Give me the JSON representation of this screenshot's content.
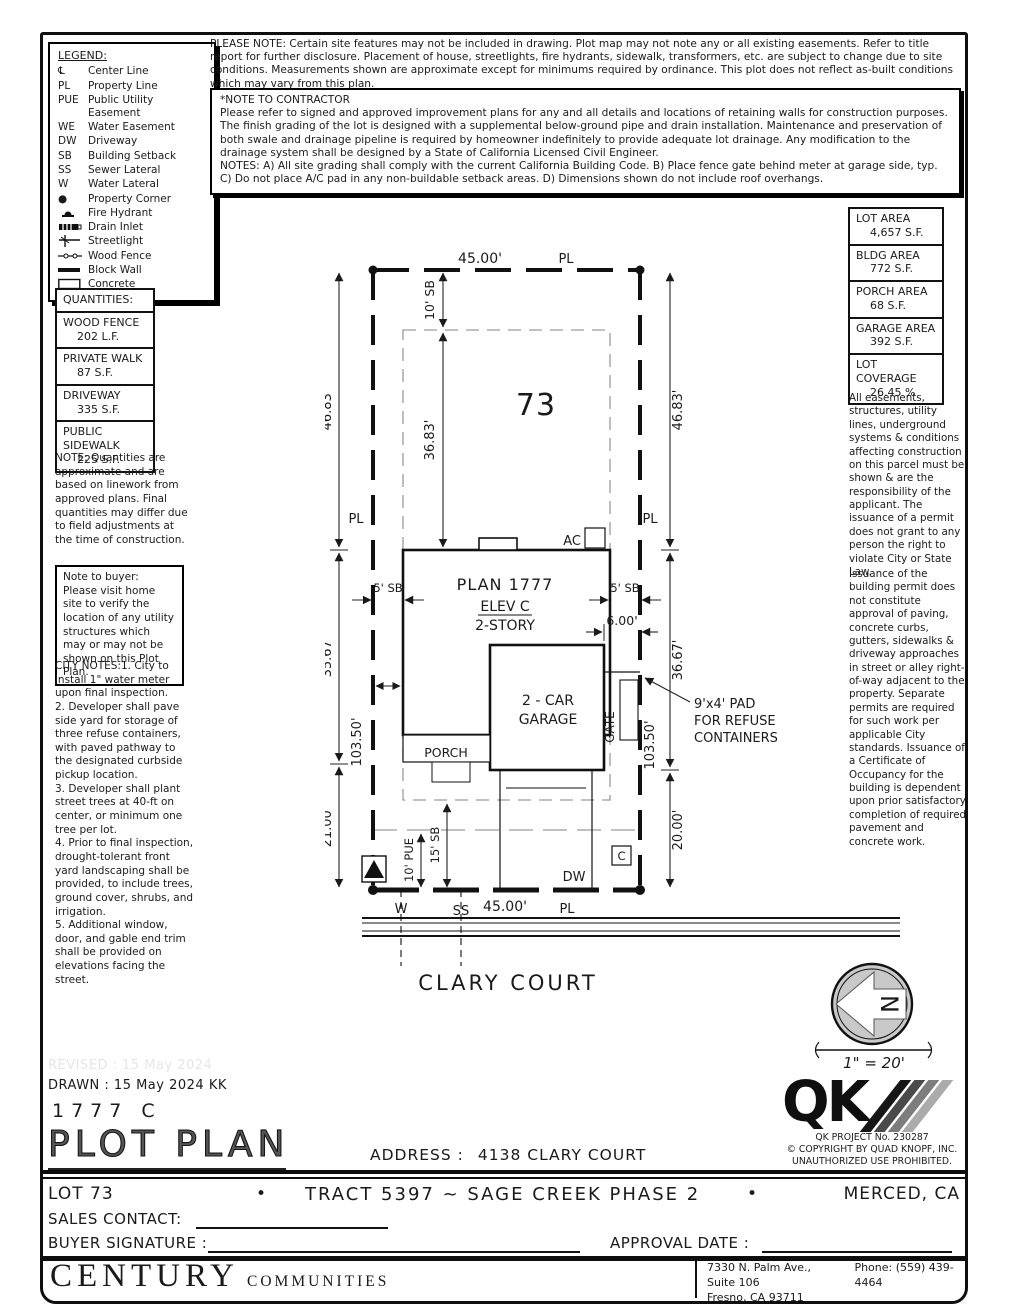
{
  "header": {
    "please_note": "PLEASE NOTE:  Certain site features may not be included in drawing.  Plot map may not note any or all existing easements. Refer to title report for further disclosure.  Placement of house, streetlights, fire hydrants, sidewalk, transformers, etc. are subject to change due to site conditions.  Measurements shown are approximate except for minimums required by ordinance.  This plot does not reflect as-built conditions which may vary from this plan.",
    "contractor_note": {
      "title": "*NOTE TO CONTRACTOR",
      "line1": "Please refer to signed and approved improvement plans for any and all details and locations of retaining walls for construction purposes.",
      "line2": "The finish grading of the lot is designed with a supplemental below-ground pipe and drain installation.  Maintenance and preservation of both swale and drainage pipeline is required by homeowner indefinitely to provide adequate lot drainage.  Any modification to the drainage system shall be designed by a State of California Licensed Civil Engineer.",
      "line3": "NOTES:  A) All site grading shall comply with the current California Building Code.  B) Place fence gate behind meter at garage side, typ.  C) Do not place A/C pad in any non-buildable setback areas.  D) Dimensions shown do not include roof overhangs."
    }
  },
  "legend": {
    "title": "LEGEND:",
    "items": [
      {
        "abbr": "℄",
        "label": "Center Line"
      },
      {
        "abbr": "PL",
        "label": "Property Line"
      },
      {
        "abbr": "PUE",
        "label": "Public Utility Easement"
      },
      {
        "abbr": "WE",
        "label": "Water Easement"
      },
      {
        "abbr": "DW",
        "label": "Driveway"
      },
      {
        "abbr": "SB",
        "label": "Building Setback"
      },
      {
        "abbr": "SS",
        "label": "Sewer Lateral"
      },
      {
        "abbr": "W",
        "label": "Water Lateral"
      },
      {
        "abbr": "●",
        "label": "Property Corner"
      },
      {
        "abbr": "",
        "label": "Fire Hydrant"
      },
      {
        "abbr": "",
        "label": "Drain Inlet"
      },
      {
        "abbr": "",
        "label": "Streetlight"
      },
      {
        "abbr": "",
        "label": "Wood Fence"
      },
      {
        "abbr": "",
        "label": "Block Wall"
      },
      {
        "abbr": "",
        "label": "Concrete"
      }
    ]
  },
  "areas": {
    "rows": [
      {
        "label": "LOT AREA",
        "value": "4,657 S.F."
      },
      {
        "label": "BLDG AREA",
        "value": "772 S.F."
      },
      {
        "label": "PORCH AREA",
        "value": "68 S.F."
      },
      {
        "label": "GARAGE AREA",
        "value": "392 S.F."
      },
      {
        "label": "LOT COVERAGE",
        "value": "26.45 %"
      }
    ]
  },
  "quantities": {
    "title": "QUANTITIES:",
    "rows": [
      {
        "label": "WOOD FENCE",
        "value": "202 L.F."
      },
      {
        "label": "PRIVATE WALK",
        "value": "87 S.F."
      },
      {
        "label": "DRIVEWAY",
        "value": "335 S.F."
      },
      {
        "label": "PUBLIC SIDEWALK",
        "value": "225 S.F."
      }
    ],
    "note": "NOTE: Quantities are approximate and are based on linework from approved plans.  Final quantities may differ due to field adjustments at the time of construction."
  },
  "buyer_note": "Note to buyer: Please visit home site to verify the location of any utility structures which may or may not be shown on this Plot Plan.",
  "city_notes": {
    "title": "CITY NOTES:",
    "body": "1. City to install 1\" water meter upon final inspection.\n2. Developer shall pave side yard for storage of three refuse containers, with paved pathway to the designated curbside pickup location.\n3. Developer shall plant street trees at 40-ft on center, or minimum one tree per lot.\n4. Prior to final inspection, drought-tolerant front yard landscaping shall be provided, to include trees, ground cover, shrubs, and irrigation.\n5. Additional window, door, and gable end trim shall be provided on elevations facing the street."
  },
  "disclaimers": {
    "para1": "All easements, structures, utility lines, underground systems & conditions affecting construction on this parcel must be shown & are the responsibility of the applicant. The issuance of a permit does not grant to any person the right to violate City or State Law.",
    "para2": "Issuance of the building permit does not constitute approval of paving, concrete curbs, gutters, sidewalks & driveway approaches in street or alley right-of-way adjacent to the property. Separate permits are required for such work per applicable City standards. Issuance of a Certificate of Occupancy for the building is dependent upon prior satisfactory completion of required pavement and concrete work."
  },
  "plot": {
    "lot_number": "73",
    "labels": {
      "pl": "PL",
      "ac": "AC",
      "dw": "DW",
      "w": "W",
      "ss": "SS",
      "c": "C",
      "gate": "GATE",
      "porch": "PORCH",
      "plan_name": "PLAN 1777",
      "plan_elev": "ELEV C",
      "plan_story": "2-STORY",
      "garage_line1": "2 - CAR",
      "garage_line2": "GARAGE",
      "street": "CLARY COURT",
      "refuse_line1": "9'x4' PAD",
      "refuse_line2": "FOR REFUSE",
      "refuse_line3": "CONTAINERS"
    },
    "dims": {
      "top_width": "45.00'",
      "bottom_width": "45.00'",
      "left_upper": "46.83'",
      "right_upper": "46.83'",
      "left_mid": "35.67'",
      "right_mid": "36.67'",
      "left_lower": "21.00'",
      "right_lower": "20.00'",
      "front_sb": "10' SB",
      "sb_to_house": "36.83'",
      "side_sb_left": "5' SB",
      "side_sb_right": "5' SB",
      "garage_to_pl": "6.00'",
      "side_length_left": "103.50'",
      "side_length_right": "103.50'",
      "pue": "10' PUE",
      "street_sb": "15' SB"
    }
  },
  "north": {
    "letter": "N",
    "scale": "1\" = 20'"
  },
  "titleblock": {
    "revised": "REVISED : 15 May 2024",
    "drawn": "DRAWN :  15 May 2024   KK",
    "plan_code": "1777   C",
    "sheet_title": "PLOT PLAN",
    "address_label": "ADDRESS :",
    "address_value": "4138 CLARY COURT",
    "qk_word": "QK",
    "qk_project": "QK PROJECT No. 230287",
    "qk_copyright": "© COPYRIGHT BY QUAD KNOPF, INC.",
    "qk_unauthorized": "UNAUTHORIZED USE PROHIBITED.",
    "lot": "LOT 73",
    "bullet": "•",
    "tract": "TRACT 5397 ~ SAGE CREEK PHASE 2",
    "city": "MERCED, CA",
    "sales_contact": "SALES CONTACT:",
    "buyer_signature": "BUYER SIGNATURE :",
    "approval_date": "APPROVAL DATE :",
    "builder_name": "CENTURY",
    "builder_suffix": "COMMUNITIES",
    "builder_address": "7330 N. Palm Ave., Suite 106",
    "builder_phone": "Phone:  (559) 439-4464",
    "builder_city": "Fresno, CA  93711"
  }
}
